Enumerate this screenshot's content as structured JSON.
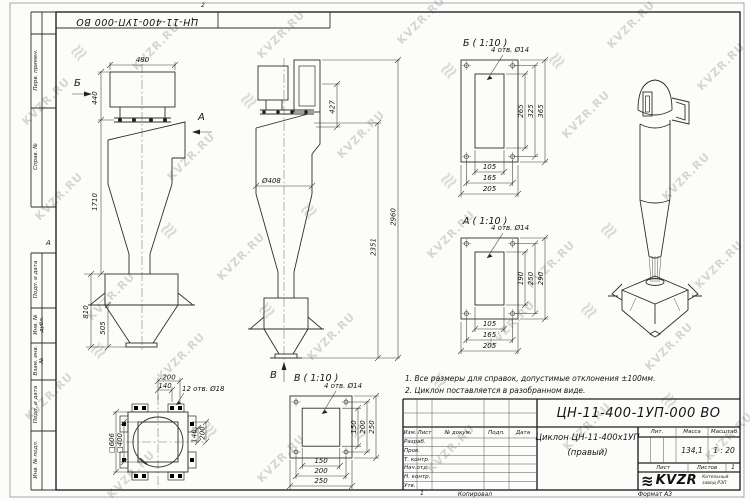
{
  "watermark": {
    "text": "KVZR.RU",
    "logo_glyph": "≋"
  },
  "frame": {
    "top_doc_number": "ЦН-11-400-1УП-000 ВО",
    "top_zone": "2",
    "left_zone": "А",
    "left_labels": [
      "Перв. примен.",
      "Справ. №",
      "Подп. и дата",
      "Инв. № дубл.",
      "Взам. инв. №",
      "Подп. и дата",
      "Инв. № подл."
    ],
    "bottom_sheet": "1",
    "bottom_copied": "Копировал",
    "bottom_format": "Формат А3"
  },
  "notes": {
    "line1": "1. Все размеры для справок, допустимые отклонения ±100мм.",
    "line2": "2. Циклон поставляется в разобранном виде."
  },
  "side_view": {
    "label_b": "Б",
    "label_a": "А",
    "dim_480": "480",
    "dim_440": "440",
    "dim_1710": "1710",
    "dim_810": "810",
    "dim_505": "505"
  },
  "front_view": {
    "label_v": "В",
    "dim_427": "427",
    "dim_2960": "2960",
    "dim_2351": "2351",
    "dim_dia": "Ø408"
  },
  "detail_b": {
    "title": "Б ( 1:10 )",
    "holes": "4 отв. Ø14",
    "h": [
      "105",
      "165",
      "205"
    ],
    "v": [
      "265",
      "325",
      "365"
    ]
  },
  "detail_a": {
    "title": "А ( 1:10 )",
    "holes": "4 отв. Ø14",
    "h": [
      "105",
      "165",
      "205"
    ],
    "v": [
      "190",
      "250",
      "290"
    ]
  },
  "detail_v": {
    "title": "В ( 1:10 )",
    "holes": "4 отв. Ø14",
    "h": [
      "150",
      "200",
      "250"
    ],
    "v": [
      "150",
      "200",
      "250"
    ]
  },
  "base_plan": {
    "holes": "12 отв. Ø18",
    "dim_200t": "200",
    "dim_140t": "140",
    "dim_140r": "140",
    "dim_200r": "200",
    "sq_outer": "□606",
    "sq_inner": "□400"
  },
  "title_block": {
    "designation": "ЦН-11-400-1УП-000 ВО",
    "name_line1": "Циклон ЦН-11-400х1УП",
    "name_line2": "(правый)",
    "cols": [
      "Изм.",
      "Лист",
      "№ докум.",
      "Подп.",
      "Дата"
    ],
    "rows": [
      "Разраб.",
      "Пров.",
      "Т. контр.",
      "Нач.отд.",
      "Н. контр.",
      "Утв."
    ],
    "lit_label": "Лит.",
    "mass_label": "Масса",
    "scale_label": "Масштаб",
    "mass_value": "134,1",
    "scale_value": "1 : 20",
    "sheet_label": "Лист",
    "sheets_label": "Листов",
    "sheets_value": "1",
    "logo_text": "KVZR",
    "logo_sub1": "Котельный",
    "logo_sub2": "завод РЭП"
  }
}
